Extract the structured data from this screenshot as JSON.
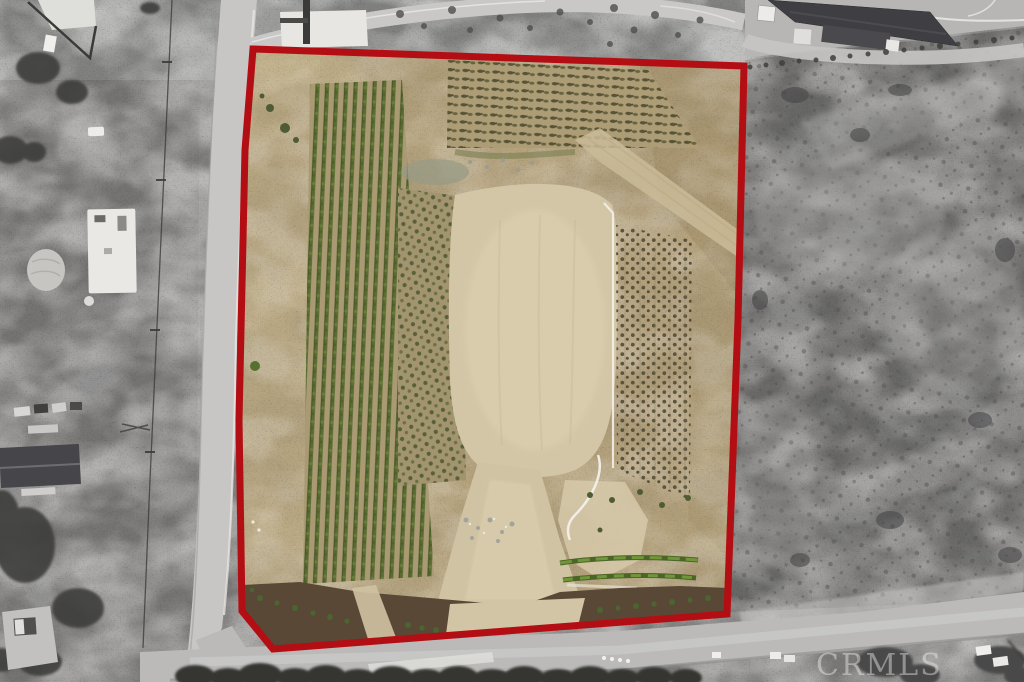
{
  "image": {
    "kind": "aerial-drone-photo",
    "subject": "Agricultural parcel with vineyard rows, young orchards and a graded dirt clearing, outlined by a red property boundary; surrounding roads, buildings and scrubland shown in grayscale",
    "width_px": 1024,
    "height_px": 682
  },
  "watermark": {
    "text": "CRMLS"
  },
  "property_boundary": {
    "color": "#b30e13",
    "stroke_width_px": 7,
    "outline_points": "253,49 744,66 738,320 727,614 273,649 242,611 239,420 245,150"
  },
  "colors": {
    "outside_gray": "#a6a5a3",
    "outside_scrub_dark": "#8e8d8b",
    "road_gray": "#c7c6c4",
    "bottom_road_gray": "#bbbab8",
    "field_tan": "#b6a47f",
    "clearing_beige": "#d3c6a6",
    "vine_row_green": "#5a6c33",
    "hedge_green": "#4c6428",
    "mulch_brown": "#5a4837",
    "watermark_white": "#f5f5f5"
  },
  "parcel_features": [
    "vineyard-rows",
    "young-orchard-top",
    "orchard-center",
    "orchard-right",
    "graded-dirt-clearing",
    "dirt-path",
    "hedge-rows",
    "mulch-strip-with-shrubs",
    "irrigation-pipe-lines"
  ],
  "surroundings_features": [
    "left-road",
    "bottom-road",
    "power-line",
    "concrete-pad",
    "barn-building",
    "warehouse-building",
    "truck-trailer",
    "trees",
    "house-with-yard",
    "parked-vehicles",
    "curved-driveway"
  ]
}
